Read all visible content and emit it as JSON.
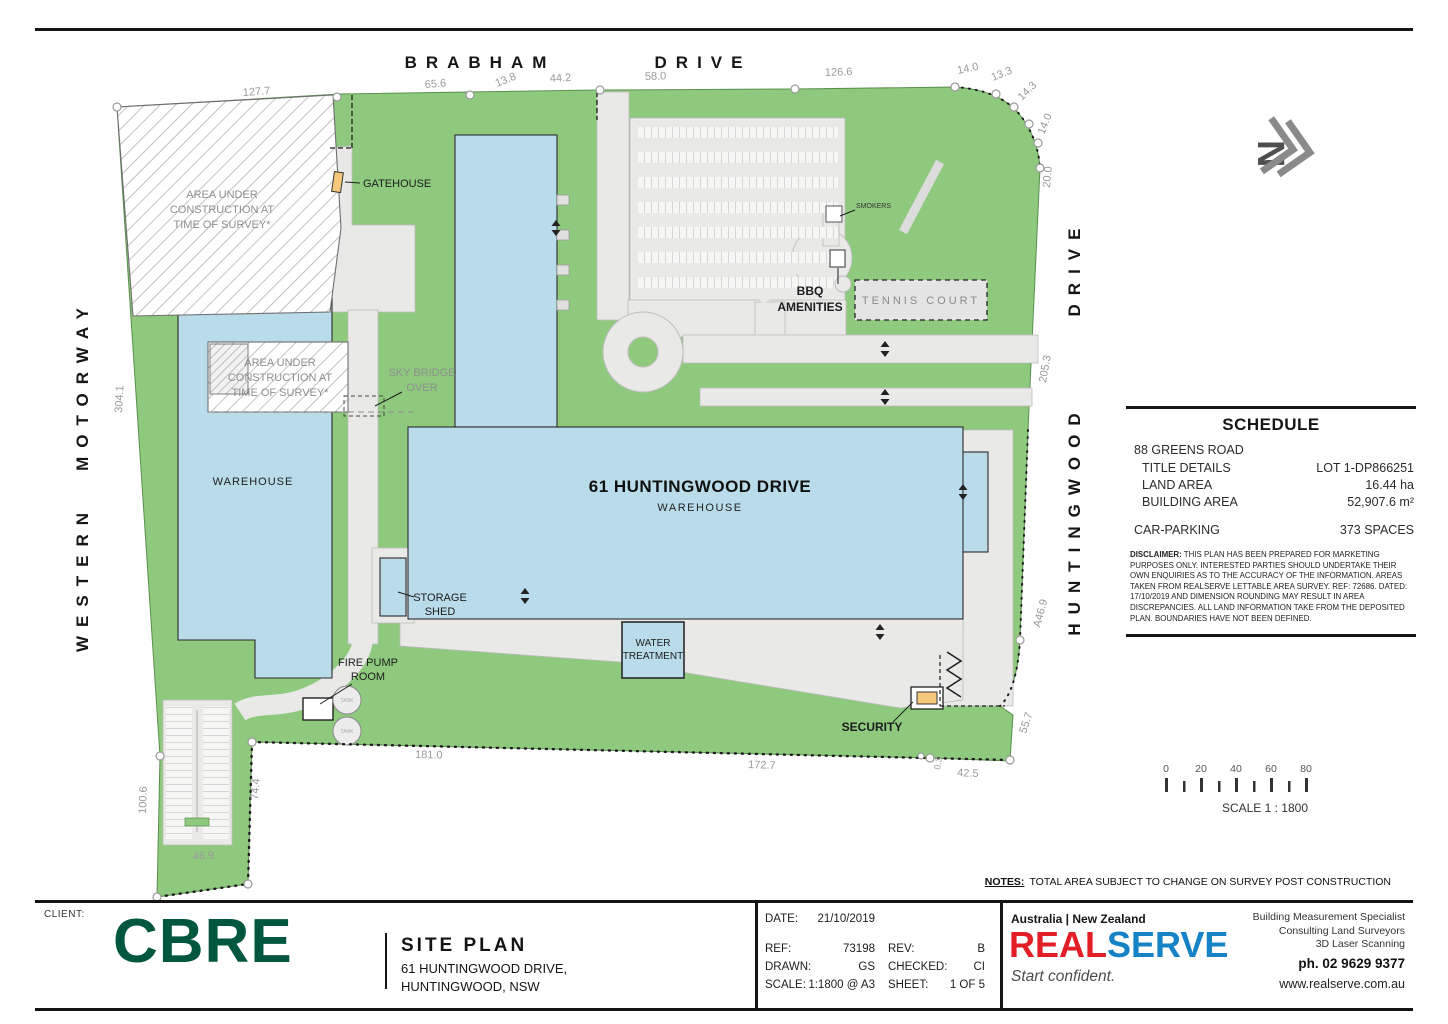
{
  "colors": {
    "land_green": "#8ec97e",
    "building_blue": "#badbe9",
    "paving_grey": "#e9e9e8",
    "cbre_green": "#00573d",
    "realserve_red": "#e31e26",
    "realserve_blue": "#1583c5",
    "highlight_orange": "#f6c87c"
  },
  "plan": {
    "streets": {
      "brabham": "BRABHAM",
      "drive_top": "DRIVE",
      "western": "WESTERN",
      "motorway": "MOTORWAY",
      "huntingwood": "HUNTINGWOOD",
      "drive_right": "DRIVE"
    },
    "labels": {
      "construction_l1": "AREA UNDER",
      "construction_l2": "CONSTRUCTION AT",
      "construction_l3": "TIME OF SURVEY*",
      "gatehouse": "GATEHOUSE",
      "sky_bridge_l1": "SKY BRIDGE",
      "sky_bridge_l2": "OVER",
      "warehouse_left": "WAREHOUSE",
      "main_building_title": "61 HUNTINGWOOD DRIVE",
      "main_building_sub": "WAREHOUSE",
      "storage_shed_l1": "STORAGE",
      "storage_shed_l2": "SHED",
      "water_treatment_l1": "WATER",
      "water_treatment_l2": "TREATMENT",
      "fire_pump_l1": "FIRE PUMP",
      "fire_pump_l2": "ROOM",
      "tank": "TANK",
      "security": "SECURITY",
      "smokers": "SMOKERS",
      "bbq_l1": "BBQ",
      "bbq_l2": "AMENITIES",
      "tennis_court": "TENNIS COURT"
    },
    "dimensions": {
      "d127_7": "127.7",
      "d65_6": "65.6",
      "d13_8": "13.8",
      "d44_2": "44.2",
      "d58_0": "58.0",
      "d126_6": "126.6",
      "d14_0a": "14.0",
      "d13_3": "13.3",
      "d14_3": "14.3",
      "d14_0b": "14.0",
      "d20_0": "20.0",
      "d304_1": "304.1",
      "d205_3": "205.3",
      "dA46_9": "A46.9",
      "d55_7": "55.7",
      "d100_6": "100.6",
      "d74_4": "74.4",
      "d46_9": "46.9",
      "d181_0": "181.0",
      "d172_7": "172.7",
      "d42_5": "42.5",
      "d0_3": "0.3"
    }
  },
  "schedule": {
    "title": "SCHEDULE",
    "address": "88 GREENS ROAD",
    "rows": [
      {
        "label": "TITLE DETAILS",
        "value": "LOT 1-DP866251"
      },
      {
        "label": "LAND AREA",
        "value": "16.44 ha"
      },
      {
        "label": "BUILDING AREA",
        "value": "52,907.6 m²"
      }
    ],
    "parking_label": "CAR-PARKING",
    "parking_value": "373 SPACES",
    "disclaimer_label": "DISCLAIMER:",
    "disclaimer_text": "THIS PLAN HAS BEEN PREPARED FOR MARKETING PURPOSES ONLY. INTERESTED PARTIES SHOULD UNDERTAKE THEIR OWN ENQUIRIES AS TO THE ACCURACY OF THE INFORMATION. AREAS TAKEN FROM REALSERVE LETTABLE AREA SURVEY. REF: 72686. DATED: 17/10/2019 AND DIMENSION ROUNDING MAY RESULT IN AREA DISCREPANCIES. ALL LAND INFORMATION TAKE FROM THE DEPOSITED PLAN. BOUNDARIES HAVE NOT BEEN DEFINED."
  },
  "scalebar": {
    "ticks": [
      "0",
      "20",
      "40",
      "60",
      "80"
    ],
    "label": "SCALE 1 : 1800"
  },
  "notes": {
    "label": "NOTES:",
    "text": "TOTAL AREA SUBJECT TO CHANGE ON SURVEY POST CONSTRUCTION"
  },
  "titleblock": {
    "client_label": "CLIENT:",
    "client_logo": "CBRE",
    "plan_title": "SITE PLAN",
    "address1": "61 HUNTINGWOOD DRIVE,",
    "address2": "HUNTINGWOOD, NSW",
    "fields": {
      "date_label": "DATE:",
      "date": "21/10/2019",
      "ref_label": "REF:",
      "ref": "73198",
      "rev_label": "REV:",
      "rev": "B",
      "drawn_label": "DRAWN:",
      "drawn": "GS",
      "checked_label": "CHECKED:",
      "checked": "CI",
      "scale_label": "SCALE:",
      "scale": "1:1800 @ A3",
      "sheet_label": "SHEET:",
      "sheet": "1 OF 5"
    },
    "realserve": {
      "region": "Australia | New Zealand",
      "brand_real": "REAL",
      "brand_serve": "SERVE",
      "tagline": "Start confident.",
      "services": [
        "Building Measurement Specialist",
        "Consulting Land Surveyors",
        "3D Laser Scanning"
      ],
      "phone": "ph. 02 9629 9377",
      "website": "www.realserve.com.au"
    }
  }
}
